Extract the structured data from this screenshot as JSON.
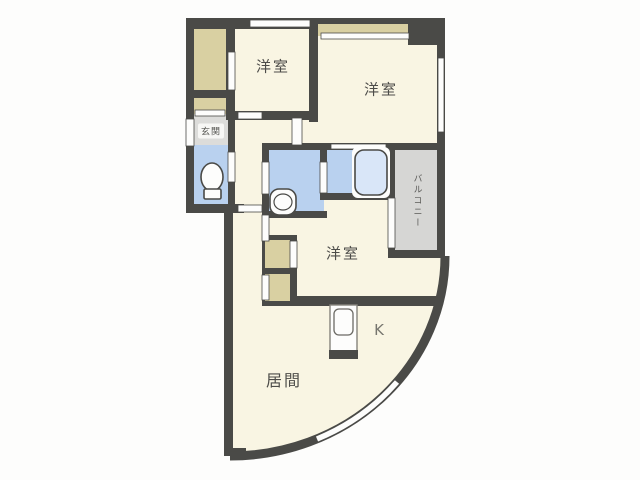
{
  "plan": {
    "type": "apartment-floor-plan",
    "rooms": {
      "bedroom_top_left": {
        "label": "洋室"
      },
      "bedroom_top_right": {
        "label": "洋室"
      },
      "bedroom_middle": {
        "label": "洋室"
      },
      "living_room": {
        "label": "居間"
      },
      "kitchen": {
        "label": "K"
      },
      "entrance": {
        "label": "玄関"
      },
      "balcony": {
        "label": "バルコニー"
      }
    },
    "fixtures": [
      "toilet-icon",
      "bathtub-icon",
      "washbasin-icon",
      "kitchen-sink-icon"
    ],
    "colors": {
      "wall": "#4a4a47",
      "floor": "#f9f5e3",
      "closet": "#d9d0a2",
      "wet_room": "#b9d1ef",
      "bathtub": "#d9e6f8",
      "balcony": "#d6d6d4",
      "entrance_floor": "#dcdcda",
      "background": "#fdfdfc"
    }
  }
}
